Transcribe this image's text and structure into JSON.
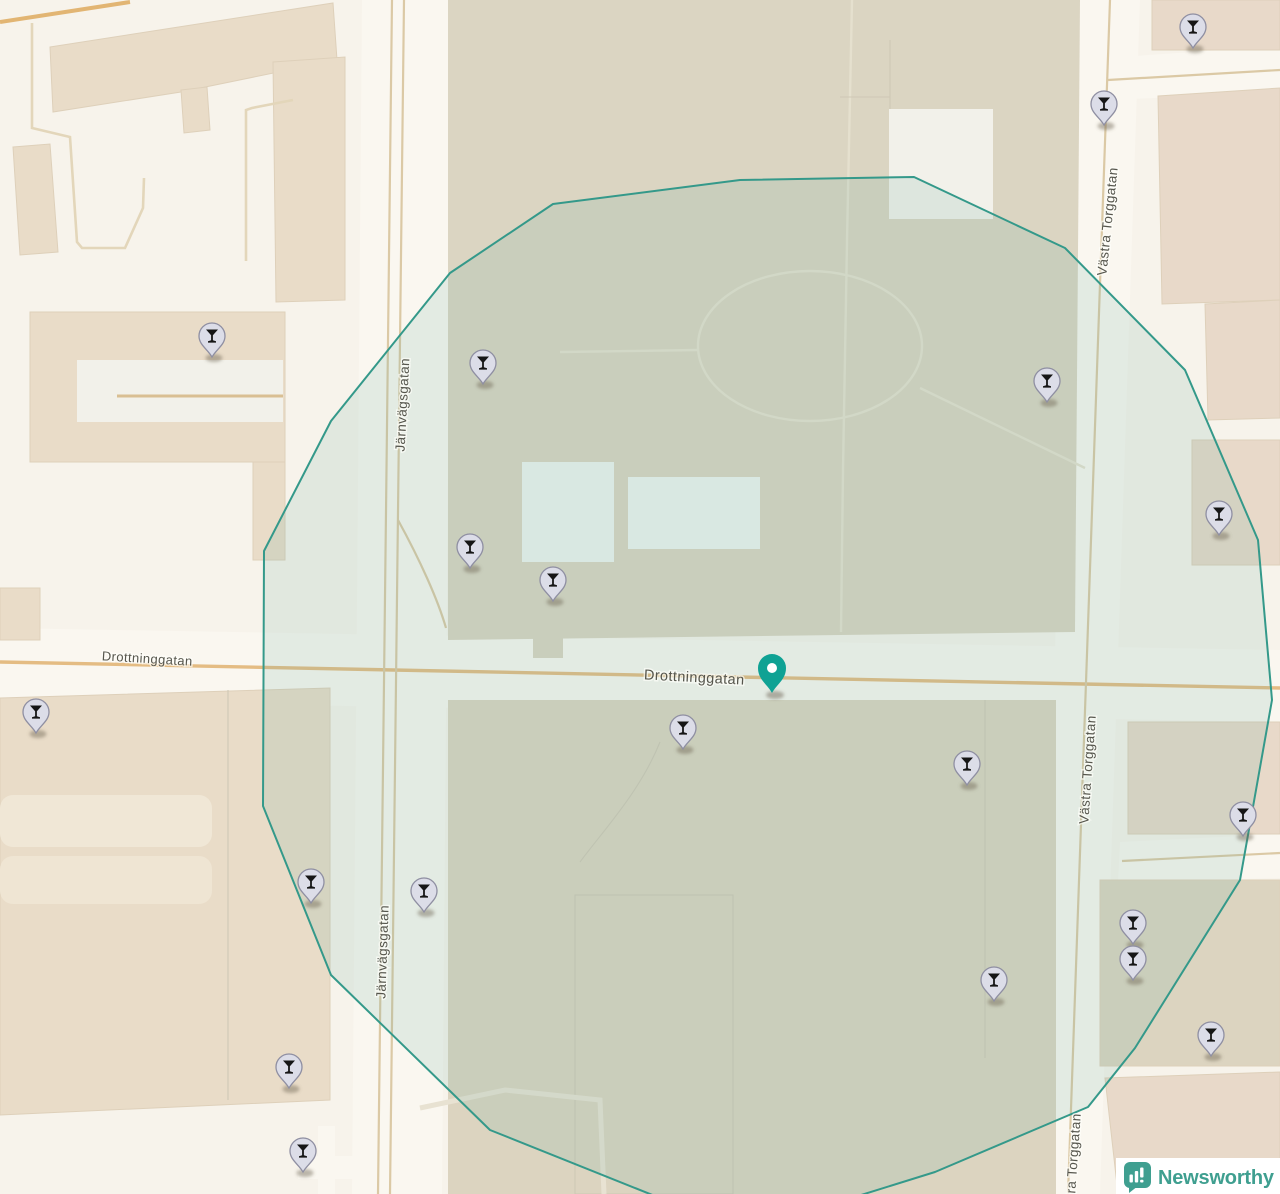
{
  "map": {
    "street_labels": [
      {
        "text": "Drottninggatan",
        "x": 147,
        "y": 663,
        "rotate": 3.5,
        "size": 13
      },
      {
        "text": "Drottninggatan",
        "x": 694,
        "y": 682,
        "rotate": 3,
        "size": 14.5
      },
      {
        "text": "Järnvägsgatan",
        "x": 407,
        "y": 405,
        "rotate": -87,
        "size": 13.5
      },
      {
        "text": "Järnvägsgatan",
        "x": 387,
        "y": 952,
        "rotate": -88,
        "size": 13.5
      },
      {
        "text": "Västra Torggatan",
        "x": 1112,
        "y": 222,
        "rotate": -84,
        "size": 13.5
      },
      {
        "text": "Västra Torggatan",
        "x": 1092,
        "y": 770,
        "rotate": -86,
        "size": 13.5
      },
      {
        "text": "Västra Torggatan",
        "x": 1077,
        "y": 1168,
        "rotate": -86,
        "size": 13.5
      }
    ],
    "markers": {
      "glyph": "martini-glass",
      "count": 20,
      "positions": [
        {
          "x": 1193,
          "y": 27
        },
        {
          "x": 1104,
          "y": 104
        },
        {
          "x": 212,
          "y": 336
        },
        {
          "x": 483,
          "y": 363
        },
        {
          "x": 1047,
          "y": 381
        },
        {
          "x": 1219,
          "y": 514
        },
        {
          "x": 470,
          "y": 547
        },
        {
          "x": 553,
          "y": 580
        },
        {
          "x": 36,
          "y": 712
        },
        {
          "x": 683,
          "y": 728
        },
        {
          "x": 967,
          "y": 764
        },
        {
          "x": 1243,
          "y": 815
        },
        {
          "x": 311,
          "y": 882
        },
        {
          "x": 424,
          "y": 891
        },
        {
          "x": 1133,
          "y": 923
        },
        {
          "x": 1133,
          "y": 959
        },
        {
          "x": 994,
          "y": 980
        },
        {
          "x": 1211,
          "y": 1035
        },
        {
          "x": 289,
          "y": 1067
        },
        {
          "x": 303,
          "y": 1151
        }
      ]
    },
    "target_pin": {
      "x": 772,
      "y": 693
    },
    "radius_polygon": {
      "points": "264,551 331,421 450,273 553,204 740,180 914,177 1065,248 1185,370 1258,540 1272,700 1240,880 1135,1048 1088,1107 935,1172 800,1214 655,1196 490,1130 331,975 263,806"
    },
    "colors": {
      "bg": "#f7f3eb",
      "building": "#e9dcc8",
      "building_pink": "#e8d9c9",
      "building_muted": "#dcd4c0",
      "park": "#dbd5c2",
      "road": "#faf7f0",
      "centerline_major": "#e4bc83",
      "centerline_minor": "#dbc9a5",
      "radius_stroke": "#34998a",
      "radius_fill": "rgba(111,177,160,0.16)",
      "marker_fill": "#dcdde8",
      "marker_stroke": "#8f8fa2",
      "marker_glyph": "#161616",
      "target_pin": "#0fa294",
      "label": "#56564d",
      "logo": "#3f9f90"
    },
    "attribution": {
      "text": "Newsworthy"
    }
  }
}
